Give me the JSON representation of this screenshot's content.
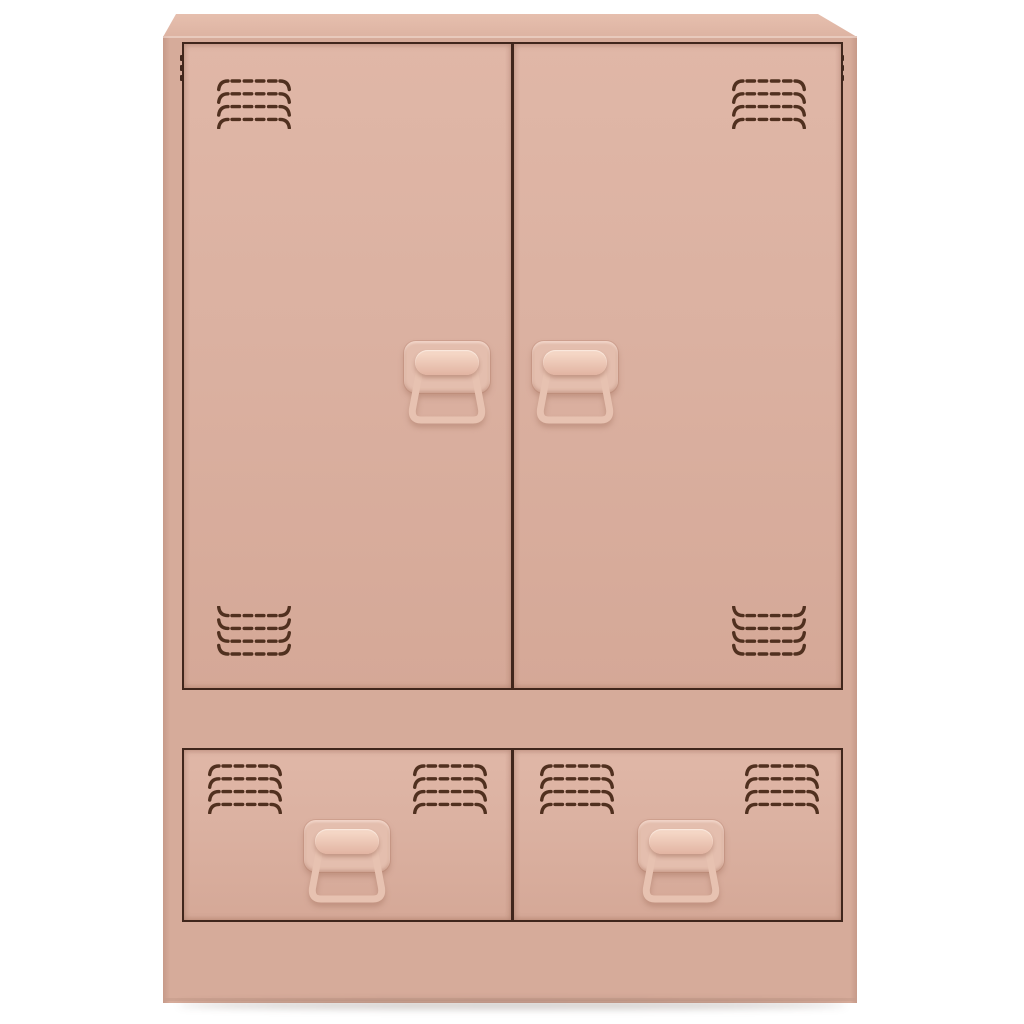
{
  "meta": {
    "domain": "natural-image",
    "description": "Studio product photo of a pink powder-coated steel storage cabinet (sideboard) with two louvered doors above two louvered drawers, shown front-on against a plain white background with a soft floor shadow."
  },
  "product": {
    "item": "storage cabinet / sideboard",
    "material_look": "powder-coated steel",
    "color_name": "pink / blush",
    "doors": 2,
    "drawers": 2,
    "door_handles": 2,
    "drawer_handles": 2,
    "handle_type": "fold-down latch handle with backplate, cylinder grip and wire bail",
    "vent_groups_per_door": 2,
    "vent_groups_per_drawer": 2,
    "vent_rows_per_group": 4
  },
  "palette": {
    "bg": "#ffffff",
    "top1": "#e6bfae",
    "top2": "#ddb3a2",
    "frame": "#d6ab9a",
    "door1": "#e0b7a7",
    "door2": "#dbb1a1",
    "door3": "#d5a897",
    "line": "#40261c",
    "vent": "#50301f",
    "hbase": "#e4beae",
    "cyl1": "#f4d6c5",
    "cyl2": "#e2b4a2",
    "bail": "#e7c2b1",
    "shadow": "rgba(60,40,30,0.25)"
  }
}
